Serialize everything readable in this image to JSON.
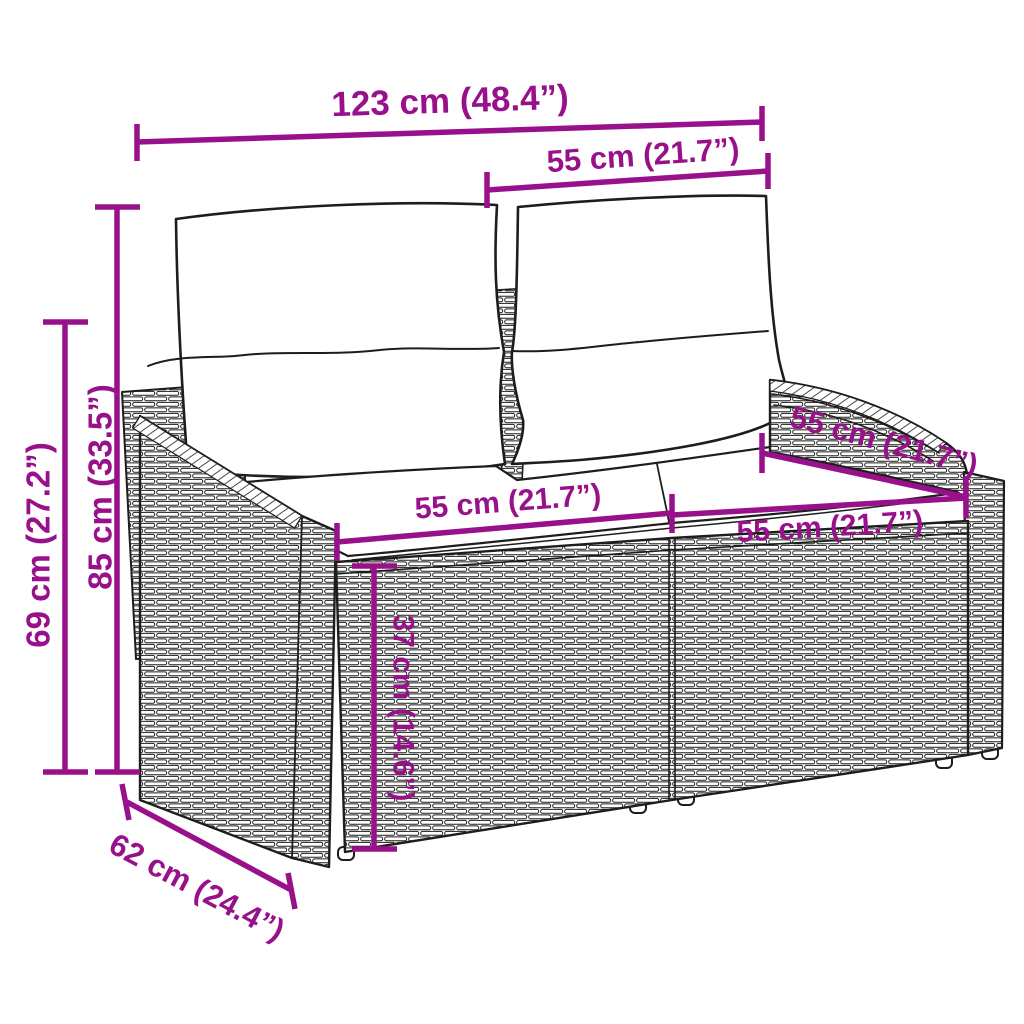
{
  "diagram": {
    "kind": "product-dimension-diagram",
    "subject": "poly rattan 2-seater garden sofa with back pillows and seat cushions"
  },
  "colors": {
    "dimension_accent": "#98118B",
    "line_art": "#1D1D1B",
    "background": "#FFFFFF",
    "cushion_fill": "#FFFFFF"
  },
  "dimensions": {
    "overall_width": "123 cm (48.4”)",
    "backrest_section_width": "55 cm (21.7”)",
    "total_height": "85 cm (33.5”)",
    "armrest_height": "69 cm (27.2”)",
    "seat_depth": "55 cm (21.7”)",
    "seat_section_width_left": "55 cm (21.7”)",
    "seat_section_width_right": "55 cm (21.7”)",
    "seat_height": "37 cm (14.6”)",
    "side_depth": "62 cm (24.4”)"
  }
}
